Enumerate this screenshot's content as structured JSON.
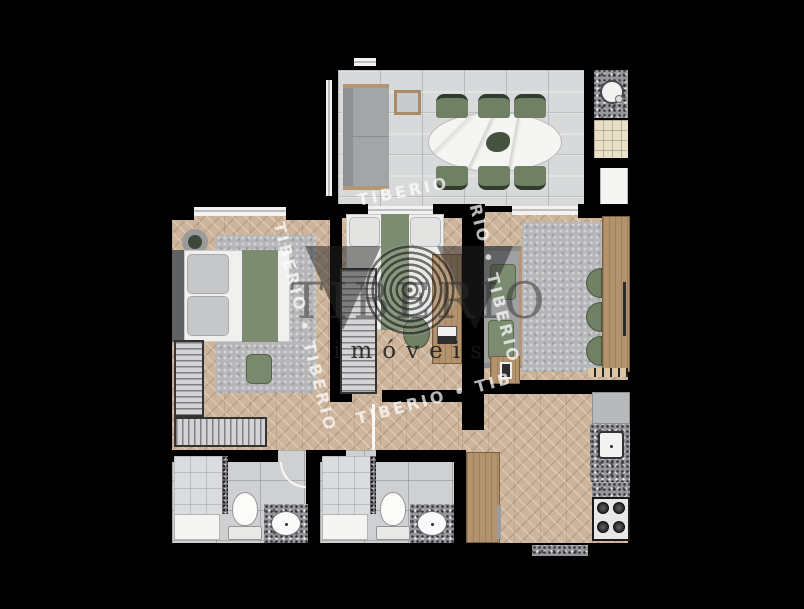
{
  "watermark": {
    "brand": "TIBERIO",
    "tagline": "imóveis",
    "diagonal_texts": [
      "TIBERIO",
      "TIBERIO • TIBERIO",
      "RIO • TIBERIO",
      "TIBERIO • TIB"
    ]
  },
  "palette": {
    "background": "#000000",
    "wall": "#000000",
    "wood": "#cdb49a",
    "tile": "#d8d9da",
    "bath_tile": "#cfd0d2",
    "shower_tile": "#dbdcde",
    "granite": "#96979a",
    "green": "#6f8065",
    "green_soft": "#7b8c70",
    "sofa_gray": "#a4a5a7",
    "rug_gray": "#b5b6b8",
    "wood_furniture": "#b3936e",
    "service_tile": "#e9e0ca",
    "white_fixture": "#f5f5f3",
    "headboard_gray": "#606163",
    "pillow_gray": "#c6c7c9",
    "watermark_dark": "rgba(45,45,45,0.5)",
    "watermark_white": "rgba(255,255,255,0.72)"
  }
}
